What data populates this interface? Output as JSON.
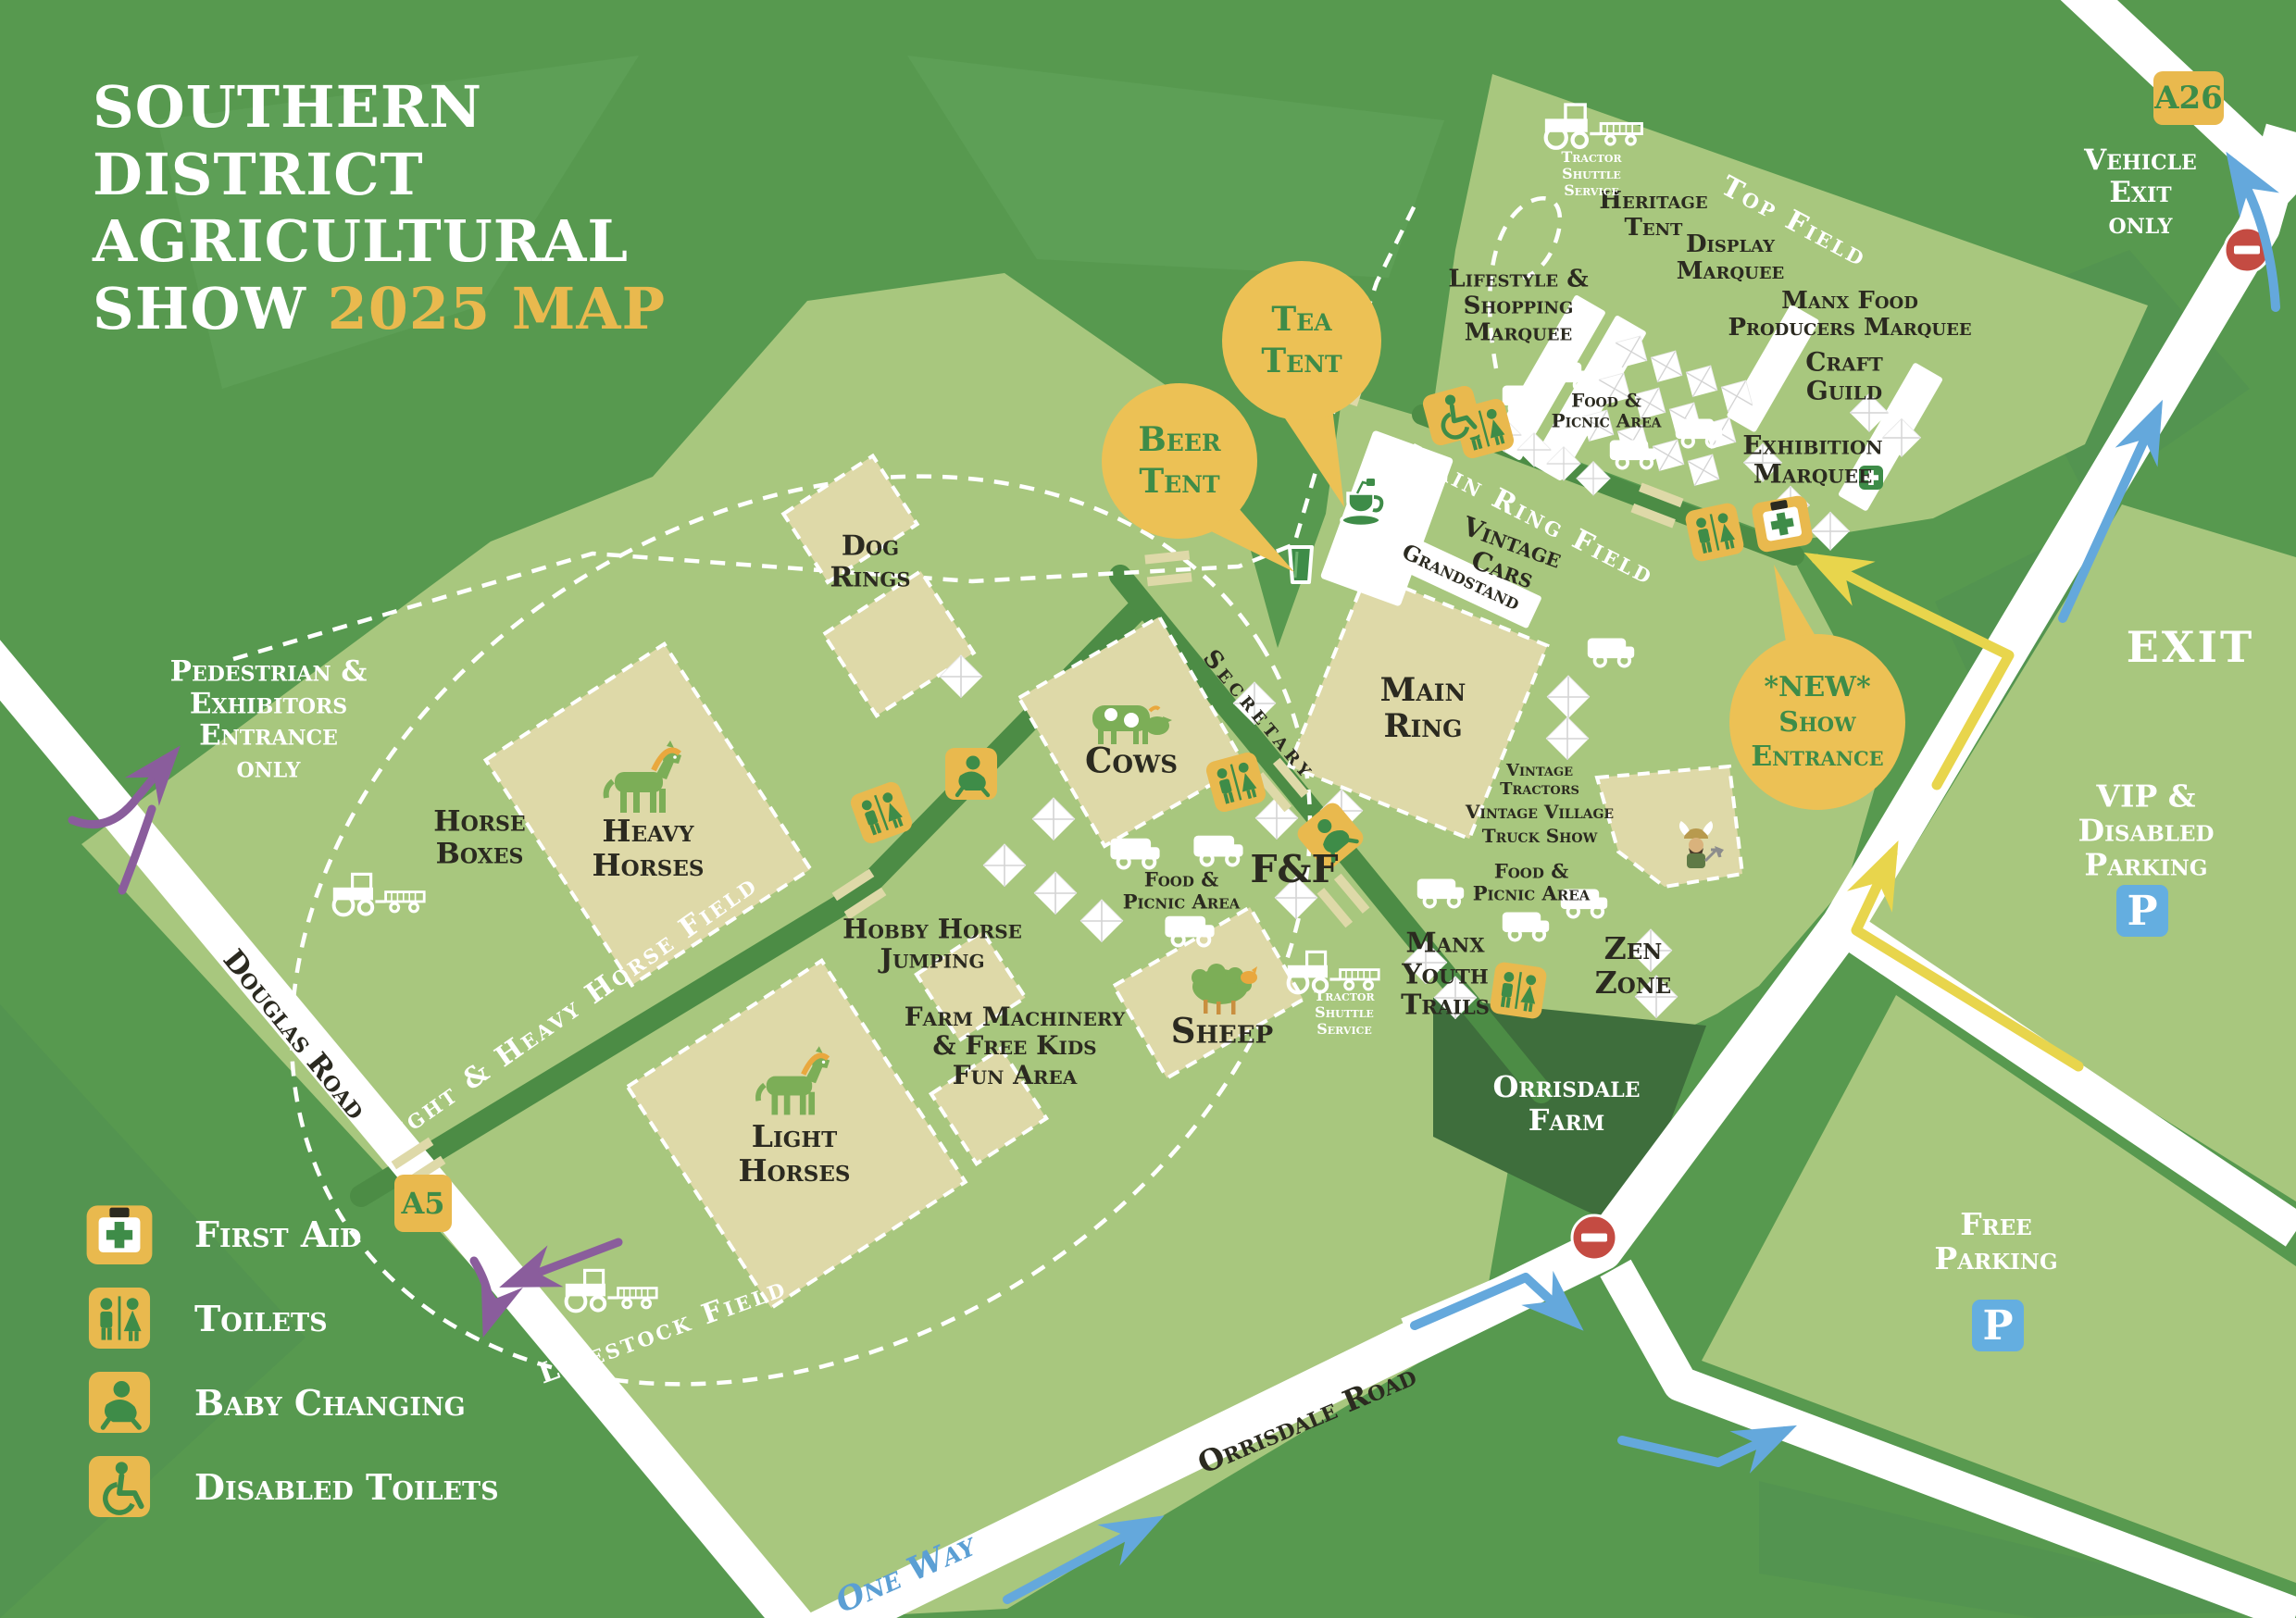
{
  "title": {
    "line1": "SOUTHERN",
    "line2": "DISTRICT",
    "line3": "AGRICULTURAL",
    "line4": "SHOW",
    "year_map": "2025 MAP"
  },
  "balloons": {
    "tea": "Tea\nTent",
    "beer": "Beer\nTent",
    "new_entrance": "*NEW*\nShow\nEntrance"
  },
  "roads": {
    "douglas": "Douglas Road",
    "orrisdale": "Orrisdale Road",
    "one_way": "One Way",
    "a5": "A5",
    "a26": "A26"
  },
  "fields": {
    "top": "Top Field",
    "main_ring": "Main Ring Field",
    "light_heavy": "Light & Heavy Horse Field",
    "livestock": "Livestock Field"
  },
  "areas": {
    "heritage": "Heritage\nTent",
    "display": "Display\nMarquee",
    "manx_food": "Manx Food\nProducers Marquee",
    "lifestyle": "Lifestyle &\nShopping\nMarquee",
    "craft": "Craft\nGuild",
    "exhibition": "Exhibition\nMarquee",
    "main_ring": "Main\nRing",
    "grandstand": "Grandstand",
    "vintage_cars": "Vintage\nCars",
    "vintage_tractors": "Vintage\nTractors",
    "vintage_village": "Vintage Village",
    "truck_show": "Truck Show",
    "food_picnic": "Food &\nPicnic Area",
    "f_and_f": "F&F",
    "manx_youth": "Manx\nYouth\nTrails",
    "zen_zone": "Zen\nZone",
    "secretary": "Secretary",
    "cows": "Cows",
    "sheep": "Sheep",
    "dog_rings": "Dog\nRings",
    "heavy_horses": "Heavy\nHorses",
    "light_horses": "Light\nHorses",
    "horse_boxes": "Horse\nBoxes",
    "hobby_horse": "Hobby Horse\nJumping",
    "farm_machinery": "Farm Machinery\n& Free Kids\nFun Area",
    "orrisdale_farm": "Orrisdale\nFarm",
    "tractor_shuttle": "Tractor\nShuttle\nService"
  },
  "entrances": {
    "pedestrian": "Pedestrian &\nExhibitors\nEntrance\nonly",
    "vehicle_exit": "Vehicle\nExit\nonly",
    "exit": "EXIT",
    "new_show": "*NEW* Show Entrance"
  },
  "parking": {
    "vip": "VIP & Disabled\nParking",
    "free": "Free\nParking",
    "p": "P"
  },
  "legend": {
    "items": [
      {
        "icon": "first-aid-icon",
        "label": "First Aid"
      },
      {
        "icon": "toilets-icon",
        "label": "Toilets"
      },
      {
        "icon": "baby-changing-icon",
        "label": "Baby Changing"
      },
      {
        "icon": "disabled-toilets-icon",
        "label": "Disabled Toilets"
      }
    ]
  },
  "colors": {
    "background_green": "#57994f",
    "field_green": "#a8c77e",
    "block_beige": "#ded9a8",
    "farm_dark_green": "#3e6e3c",
    "internal_road_green": "#4c8c45",
    "road_white": "#ffffff",
    "accent_yellow": "#e9b94e",
    "balloon_yellow": "#ecc155",
    "icon_green": "#3e8c48",
    "arrow_blue": "#64a8dc",
    "parking_blue": "#64aee0",
    "route_yellow": "#e8d54c",
    "pedestrian_purple": "#8a5d9c",
    "no_entry_red": "#c44b42",
    "text_dark": "#2b2a20"
  }
}
